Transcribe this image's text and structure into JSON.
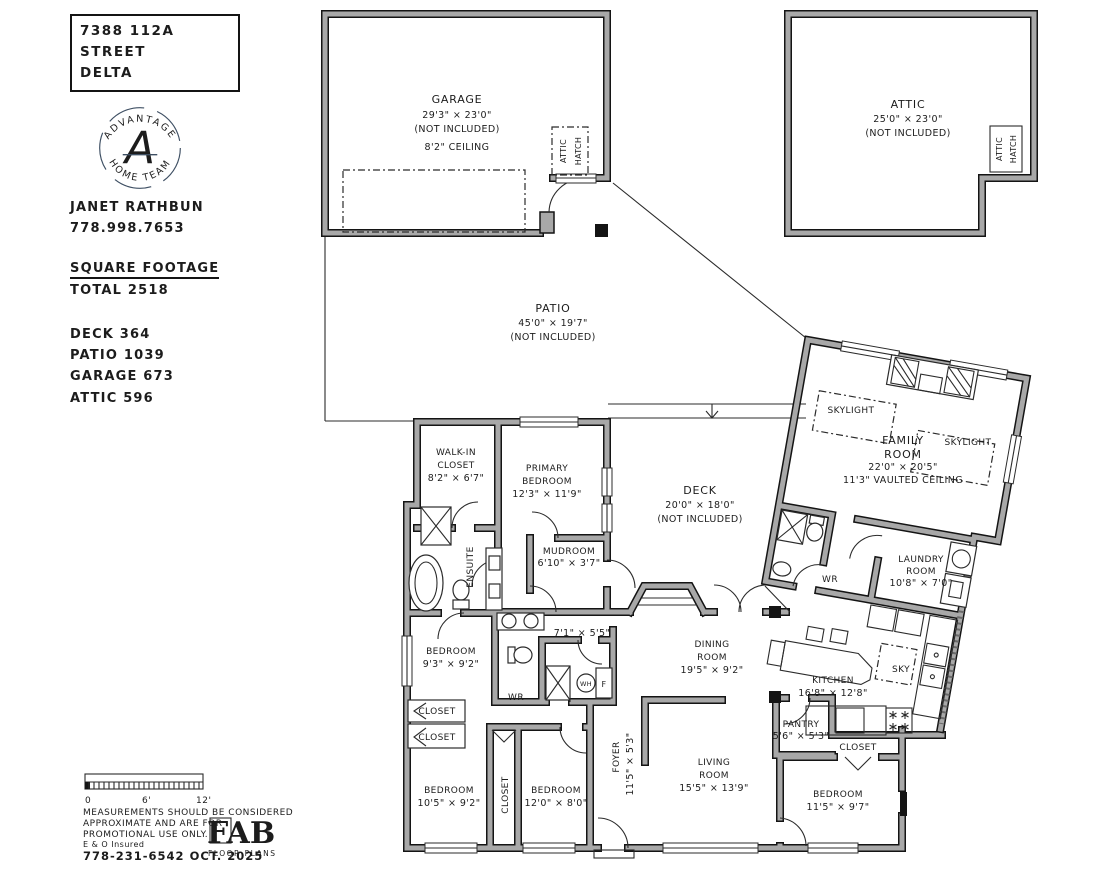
{
  "info_panel": {
    "address_line1": "7388 112A STREET",
    "address_line2": "DELTA",
    "logo": {
      "arc_top": "ADVANTAGE",
      "arc_bottom": "HOME TEAM",
      "monogram": "A",
      "color": "#3e4f63"
    },
    "agent_name": "JANET RATHBUN",
    "agent_phone": "778.998.7653",
    "sqft_heading": "SQUARE FOOTAGE",
    "sqft_total": "TOTAL 2518",
    "sqft_items": [
      "DECK 364",
      "PATIO 1039",
      "GARAGE 673",
      "ATTIC 596"
    ]
  },
  "plan": {
    "garage": {
      "name": "GARAGE",
      "dims": "29'3\" × 23'0\"",
      "note": "(NOT INCLUDED)",
      "ceiling": "8'2\" CEILING"
    },
    "attic": {
      "name": "ATTIC",
      "dims": "25'0\" × 23'0\"",
      "note": "(NOT INCLUDED)"
    },
    "attic_hatch": {
      "line1": "ATTIC",
      "line2": "HATCH"
    },
    "patio": {
      "name": "PATIO",
      "dims": "45'0\" × 19'7\"",
      "note": "(NOT INCLUDED)"
    },
    "deck": {
      "name": "DECK",
      "dims": "20'0\" × 18'0\"",
      "note": "(NOT INCLUDED)"
    },
    "family_room": {
      "line1": "FAMILY",
      "line2": "ROOM",
      "dims": "22'0\" × 20'5\"",
      "ceiling": "11'3\" VAULTED CEILING"
    },
    "skylight": "SKYLIGHT",
    "sky": "SKY",
    "walk_in_closet": {
      "line1": "WALK-IN",
      "line2": "CLOSET",
      "dims": "8'2\" × 6'7\""
    },
    "primary_bedroom": {
      "line1": "PRIMARY",
      "line2": "BEDROOM",
      "dims": "12'3\" × 11'9\""
    },
    "ensuite": "ENSUITE",
    "mudroom": {
      "name": "MUDROOM",
      "dims": "6'10\" × 3'7\""
    },
    "bedroom2": {
      "name": "BEDROOM",
      "dims": "9'3\" × 9'2\""
    },
    "wr_main": {
      "name": "WR",
      "dims": "7'1\" × 5'5\""
    },
    "water_heater": "WH",
    "furnace": "F",
    "closet": "CLOSET",
    "bedroom3": {
      "name": "BEDROOM",
      "dims": "10'5\" × 9'2\""
    },
    "bedroom4": {
      "name": "BEDROOM",
      "dims": "12'0\" × 8'0\""
    },
    "foyer": {
      "name": "FOYER",
      "dims": "11'5\" × 5'3\""
    },
    "dining_room": {
      "line1": "DINING",
      "line2": "ROOM",
      "dims": "19'5\" × 9'2\""
    },
    "living_room": {
      "line1": "LIVING",
      "line2": "ROOM",
      "dims": "15'5\" × 13'9\""
    },
    "kitchen": {
      "name": "KITCHEN",
      "dims": "16'8\" × 12'8\""
    },
    "pantry": {
      "name": "PANTRY",
      "dims": "5'6\" × 5'3\""
    },
    "bedroom5": {
      "name": "BEDROOM",
      "dims": "11'5\" × 9'7\""
    },
    "laundry": {
      "line1": "LAUNDRY",
      "line2": "ROOM",
      "dims": "10'8\" × 7'0\""
    },
    "wr_wing": "WR"
  },
  "footer": {
    "scale": {
      "t0": "0",
      "t6": "6'",
      "t12": "12'"
    },
    "disclaimer_line1": "MEASUREMENTS SHOULD BE CONSIDERED",
    "disclaimer_line2": "APPROXIMATE AND ARE FOR",
    "disclaimer_line3": "PROMOTIONAL USE ONLY.",
    "insured": "E & O Insured",
    "contact": "778-231-6542  OCT. 2025",
    "fab": {
      "name": "FAB",
      "subtitle": "FLOOR PLANS"
    }
  },
  "colors": {
    "wall_fill": "#a8a8a8",
    "wall_edge": "#141414",
    "line": "#2b2b2b",
    "logo": "#3e4f63"
  }
}
